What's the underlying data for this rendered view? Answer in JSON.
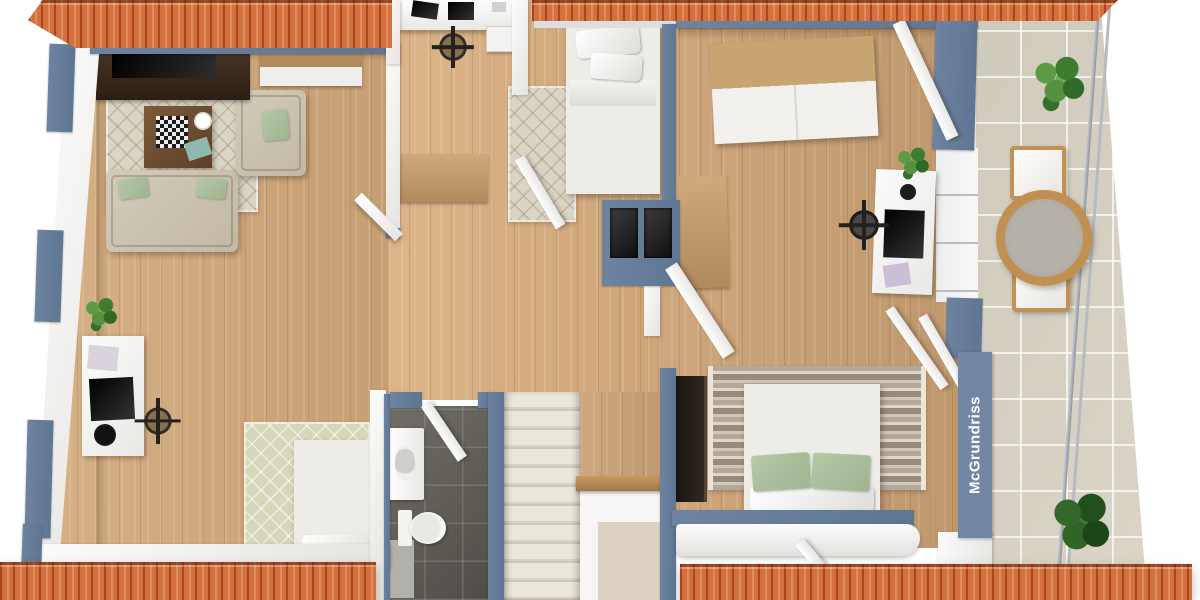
{
  "watermark": {
    "text": "McGrundriss"
  },
  "palette": {
    "roof": "#d4703c",
    "roof_dark": "#a8441f",
    "roof_light": "#e08a5a",
    "wall_blue": "#6d83a0",
    "wall_white": "#f3f2f0",
    "wood": "#caa276",
    "balcony_tile": "#d8d2c4",
    "bath_tile": "#615e57",
    "sofa": "#d2cbb8",
    "rug_beige": "#dad4c4",
    "rug_green": "#d6d6b8",
    "bed_gray": "#8b8a86",
    "pillow_green": "#b5c8a7",
    "furniture_wood": "#c3a174",
    "dark_screen": "#221d18",
    "stair_tread": "#e6e1d5",
    "plant_green": "#4c8a3e",
    "watermark_bg": "#7287a4",
    "watermark_text": "#ffffff"
  },
  "scene": {
    "type": "3d-floorplan-top-view",
    "rooms": [
      {
        "name": "living-area",
        "furniture": [
          "tv-sideboard",
          "flatscreen-tv",
          "wall-cabinet",
          "diamond-rug",
          "coffee-table",
          "chessboard",
          "corner-sofa",
          "green-throw-pillows",
          "floor-plant",
          "white-desk",
          "desk-chair",
          "single-bed",
          "green-diamond-rug",
          "sideboard",
          "storage-box"
        ]
      },
      {
        "name": "hallway-landing",
        "furniture": [
          "dormer-desk",
          "office-chair",
          "wood-dresser",
          "chimney-shafts",
          "staircase",
          "wood-railing",
          "stairwell-opening"
        ]
      },
      {
        "name": "bedroom-top",
        "furniture": [
          "single-bed",
          "white-pillows",
          "gray-duvet",
          "bedside-rug"
        ]
      },
      {
        "name": "bedroom-right",
        "furniture": [
          "wardrobe",
          "tall-cabinet",
          "white-desk",
          "monitor",
          "office-chair",
          "potted-plant",
          "double-bed",
          "green-pillows",
          "striped-rug",
          "tv-panel",
          "dormer-curve"
        ]
      },
      {
        "name": "bathroom",
        "furniture": [
          "vanity-sink",
          "toilet",
          "shower-area",
          "dark-floor-tiles"
        ]
      },
      {
        "name": "balcony",
        "furniture": [
          "potted-plant-top",
          "round-rattan-table",
          "two-chairs",
          "potted-plant-bottom",
          "slanted-railing"
        ]
      }
    ]
  }
}
